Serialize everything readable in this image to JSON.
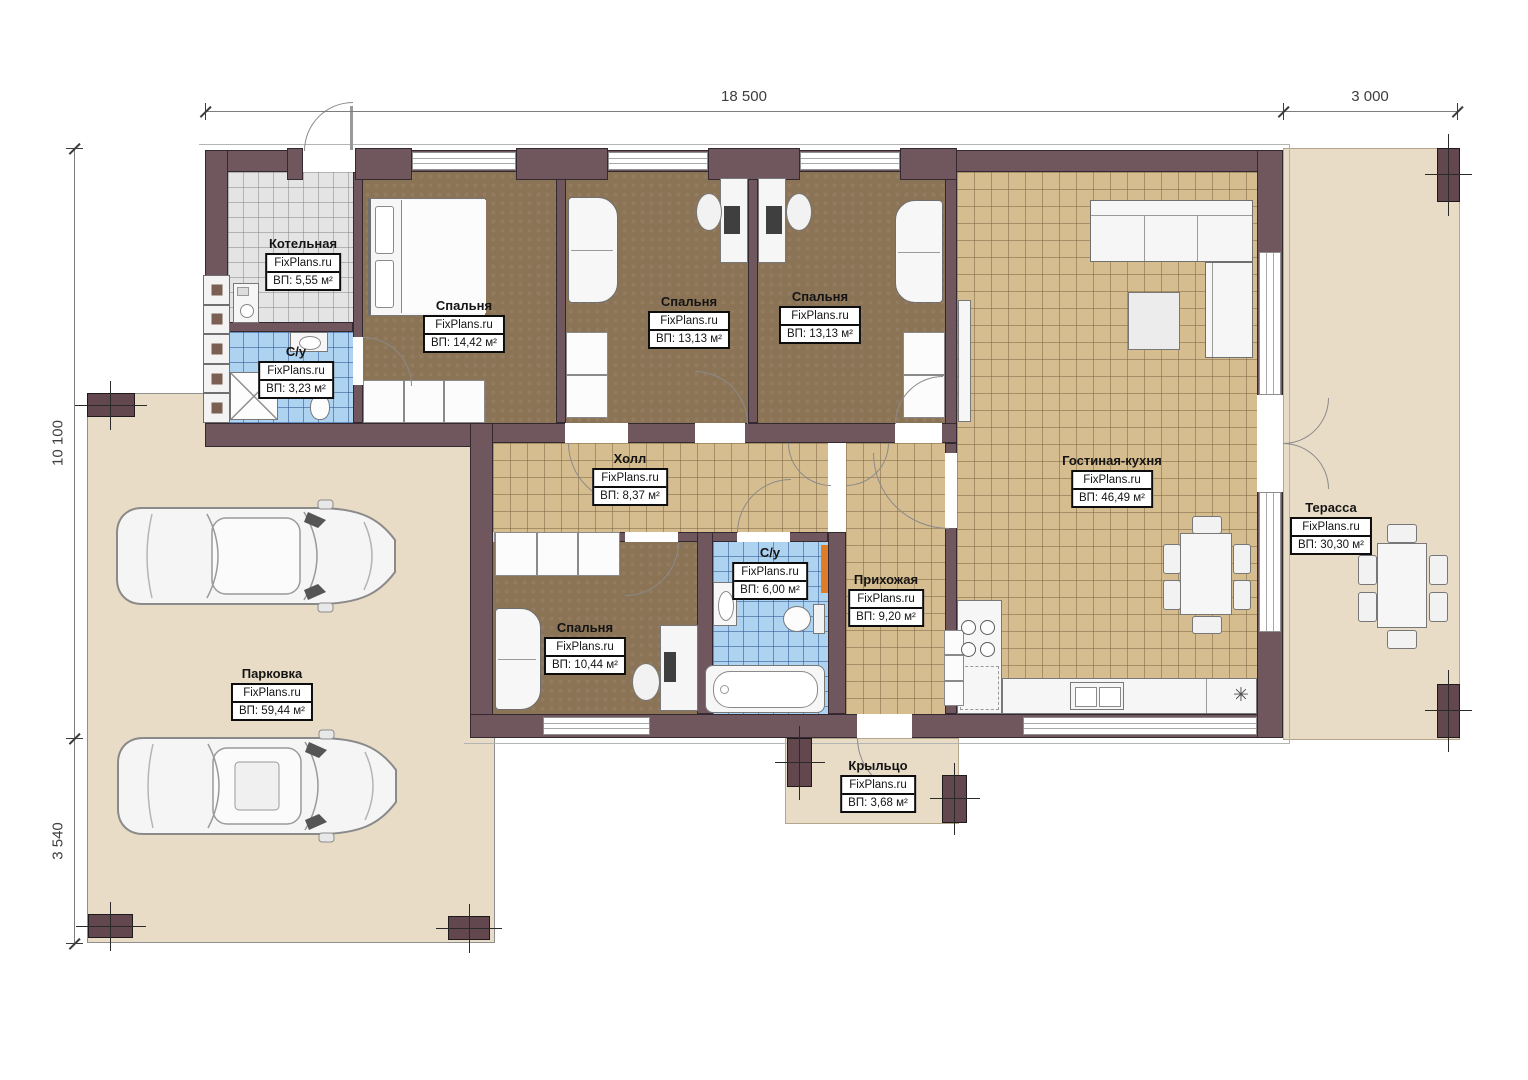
{
  "watermark": "FixPlans.ru",
  "dimensions": {
    "top_main": "18 500",
    "top_right": "3 000",
    "left_main": "10 100",
    "left_lower": "3 540"
  },
  "rooms": {
    "kotelnaya": {
      "name": "Котельная",
      "area": "ВП: 5,55 м²"
    },
    "su_small": {
      "name": "С/у",
      "area": "ВП: 3,23 м²"
    },
    "bedroom1": {
      "name": "Спальня",
      "area": "ВП: 14,42 м²"
    },
    "bedroom2": {
      "name": "Спальня",
      "area": "ВП: 13,13 м²"
    },
    "bedroom3": {
      "name": "Спальня",
      "area": "ВП: 13,13 м²"
    },
    "living_kitchen": {
      "name": "Гостиная-кухня",
      "area": "ВП: 46,49 м²"
    },
    "hall": {
      "name": "Холл",
      "area": "ВП: 8,37 м²"
    },
    "su_main": {
      "name": "С/у",
      "area": "ВП: 6,00 м²"
    },
    "hallway": {
      "name": "Прихожая",
      "area": "ВП: 9,20 м²"
    },
    "bedroom4": {
      "name": "Спальня",
      "area": "ВП: 10,44 м²"
    },
    "terrace": {
      "name": "Терасса",
      "area": "ВП: 30,30 м²"
    },
    "parking": {
      "name": "Парковка",
      "area": "ВП: 59,44 м²"
    },
    "porch": {
      "name": "Крыльцо",
      "area": "ВП: 3,68 м²"
    }
  },
  "icons": {
    "cooktop": "✳"
  },
  "colors": {
    "wall": "#6f575d",
    "floor_wood": "#8b7355",
    "tile_beige": "#d6bd8f",
    "tile_blue": "#aed3f0",
    "tile_gray": "#e4e4e4",
    "ground": "#e9dcc7",
    "accent_orange": "#e07b28"
  }
}
